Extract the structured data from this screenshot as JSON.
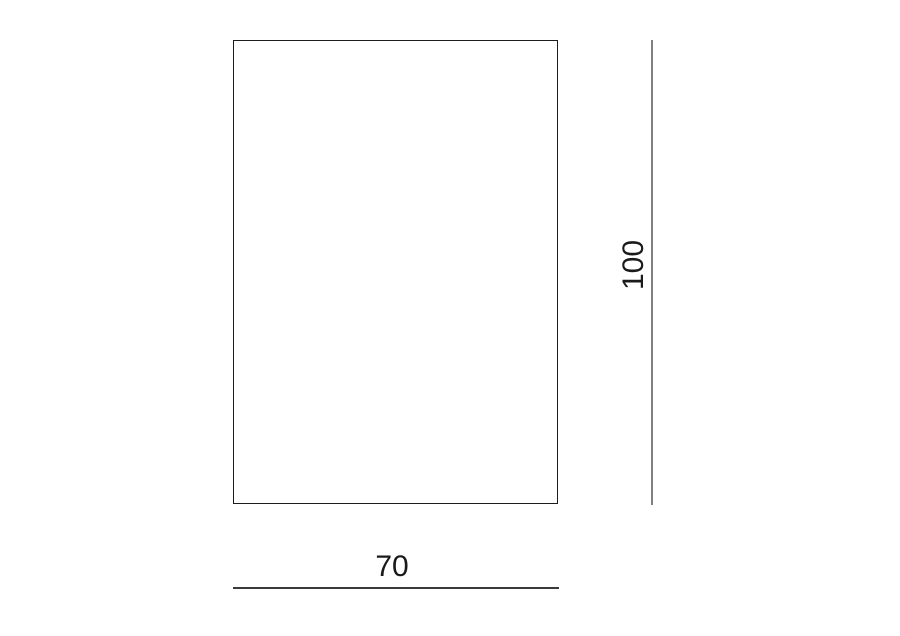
{
  "diagram": {
    "type": "dimension-drawing",
    "shape": "rectangle",
    "width_label": "70",
    "height_label": "100",
    "colors": {
      "background": "#ffffff",
      "outline": "#1c1c1c",
      "height_dimension_line": "#808080",
      "width_dimension_line": "#3a3a3a",
      "text": "#1a1a1a"
    }
  }
}
